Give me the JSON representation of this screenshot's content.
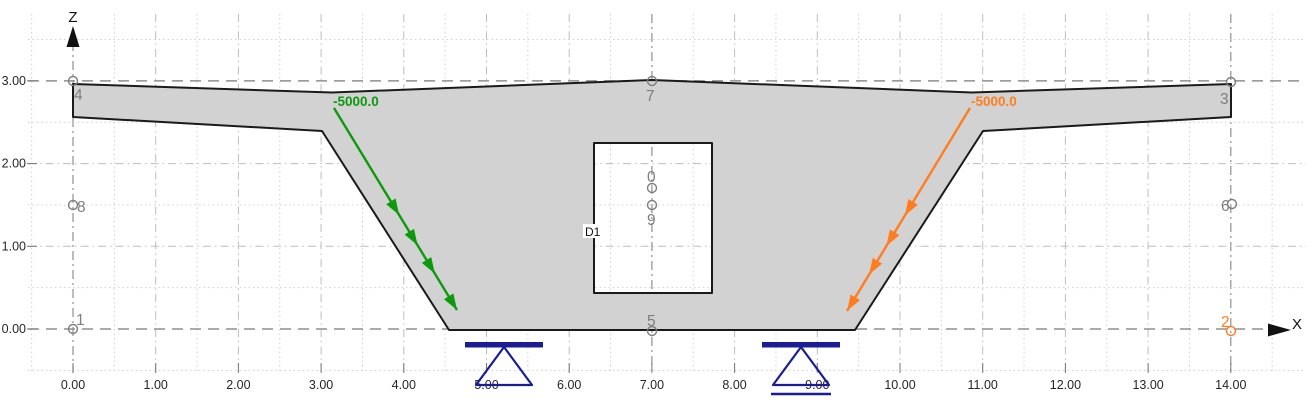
{
  "app": {
    "view": "cross-section-model-viewport"
  },
  "colors": {
    "background": "#ffffff",
    "section_fill": "#d2d2d2",
    "section_stroke": "#1a1a1a",
    "node": "#7e7e7e",
    "node_selected": "#ff7d1f",
    "load_green": "#0c9a0c",
    "load_orange": "#ff7d1f",
    "support": "#1c1c96",
    "grid_dot": "#d0d0d0",
    "grid_dashdot": "#bdbdbd",
    "grid_major": "#8f8f8f",
    "axis_text": "#262626",
    "axis_arrow": "#111111"
  },
  "plot": {
    "origin_x": 73,
    "origin_y": 329,
    "scale": 82.7,
    "grid_top": 14,
    "grid_bottom": 373,
    "grid_left": 30,
    "grid_right": 1306,
    "x_half_min": -1,
    "x_half_max": 29,
    "z_half_min": -1,
    "z_half_max": 7,
    "x_major": [
      0,
      7,
      14
    ],
    "z_major": [
      0,
      3
    ]
  },
  "axis": {
    "x_label": "X",
    "z_label": "Z",
    "x_ticks": [
      {
        "label": "0.00",
        "value": 0
      },
      {
        "label": "1.00",
        "value": 1
      },
      {
        "label": "2.00",
        "value": 2
      },
      {
        "label": "3.00",
        "value": 3
      },
      {
        "label": "4.00",
        "value": 4
      },
      {
        "label": "5.00",
        "value": 5
      },
      {
        "label": "6.00",
        "value": 6
      },
      {
        "label": "7.00",
        "value": 7
      },
      {
        "label": "8.00",
        "value": 8
      },
      {
        "label": "9.00",
        "value": 9
      },
      {
        "label": "10.00",
        "value": 10
      },
      {
        "label": "11.00",
        "value": 11
      },
      {
        "label": "12.00",
        "value": 12
      },
      {
        "label": "13.00",
        "value": 13
      },
      {
        "label": "14.00",
        "value": 14
      }
    ],
    "z_ticks": [
      {
        "label": "0.00",
        "value": 0
      },
      {
        "label": "1.00",
        "value": 1
      },
      {
        "label": "2.00",
        "value": 2
      },
      {
        "label": "3.00",
        "value": 3
      }
    ]
  },
  "section": {
    "name": "box-girder-cross-section",
    "outline": [
      [
        73,
        84
      ],
      [
        332,
        92.5
      ],
      [
        652,
        80
      ],
      [
        972,
        92.5
      ],
      [
        1231,
        84
      ],
      [
        1231,
        117
      ],
      [
        983,
        131
      ],
      [
        855,
        330
      ],
      [
        449,
        330
      ],
      [
        322,
        131
      ],
      [
        73,
        117
      ]
    ],
    "opening": {
      "label": "D1",
      "x": 594,
      "y": 143,
      "w": 118,
      "h": 150,
      "label_chip": {
        "x": 583,
        "y": 224,
        "w": 21,
        "h": 14,
        "tx": 585,
        "ty": 236
      }
    }
  },
  "nodes": [
    {
      "id": "4",
      "cx": 73,
      "cy": 81,
      "lx": 74,
      "ly": 100,
      "selected": false
    },
    {
      "id": "7",
      "cx": 652,
      "cy": 81,
      "lx": 646,
      "ly": 101,
      "selected": false
    },
    {
      "id": "3",
      "cx": 1231,
      "cy": 82,
      "lx": 1220,
      "ly": 104,
      "selected": false
    },
    {
      "id": "8",
      "cx": 73,
      "cy": 205,
      "lx": 77,
      "ly": 212,
      "selected": false
    },
    {
      "id": "6",
      "cx": 1232,
      "cy": 204,
      "lx": 1221,
      "ly": 211,
      "selected": false
    },
    {
      "id": "0",
      "cx": 652,
      "cy": 188,
      "lx": 647,
      "ly": 182,
      "selected": false
    },
    {
      "id": "9",
      "cx": 652,
      "cy": 205,
      "lx": 647,
      "ly": 225,
      "selected": false
    },
    {
      "id": "1",
      "cx": 73,
      "cy": 329,
      "lx": 76,
      "ly": 325,
      "selected": false
    },
    {
      "id": "5",
      "cx": 652,
      "cy": 331,
      "lx": 647,
      "ly": 326,
      "selected": false
    },
    {
      "id": "2",
      "cx": 1231,
      "cy": 331,
      "lx": 1221,
      "ly": 327,
      "selected": true
    }
  ],
  "loads": [
    {
      "name": "load-left",
      "value": "-5000.0",
      "color": "#0c9a0c",
      "x1": 334,
      "y1": 108,
      "x2": 457,
      "y2": 310,
      "label_x": 333,
      "label_y": 106,
      "heads": [
        0.53,
        0.68,
        0.82,
        1.0
      ]
    },
    {
      "name": "load-right",
      "value": "-5000.0",
      "color": "#ff7d1f",
      "x1": 970,
      "y1": 108,
      "x2": 847,
      "y2": 311,
      "label_x": 971,
      "label_y": 106,
      "heads": [
        0.53,
        0.68,
        0.82,
        1.0
      ]
    }
  ],
  "supports": [
    {
      "type": "pinned",
      "bar": {
        "x": 465,
        "y": 342,
        "w": 78,
        "h": 5.5
      },
      "apex_x": 504,
      "apex_y": 347,
      "base_y": 385,
      "half_base": 28,
      "roller_line": null
    },
    {
      "type": "roller",
      "bar": {
        "x": 762,
        "y": 342,
        "w": 78,
        "h": 5.5
      },
      "apex_x": 801,
      "apex_y": 347,
      "base_y": 385,
      "half_base": 28,
      "roller_line": {
        "x1": 771,
        "x2": 831,
        "y": 394
      }
    }
  ]
}
